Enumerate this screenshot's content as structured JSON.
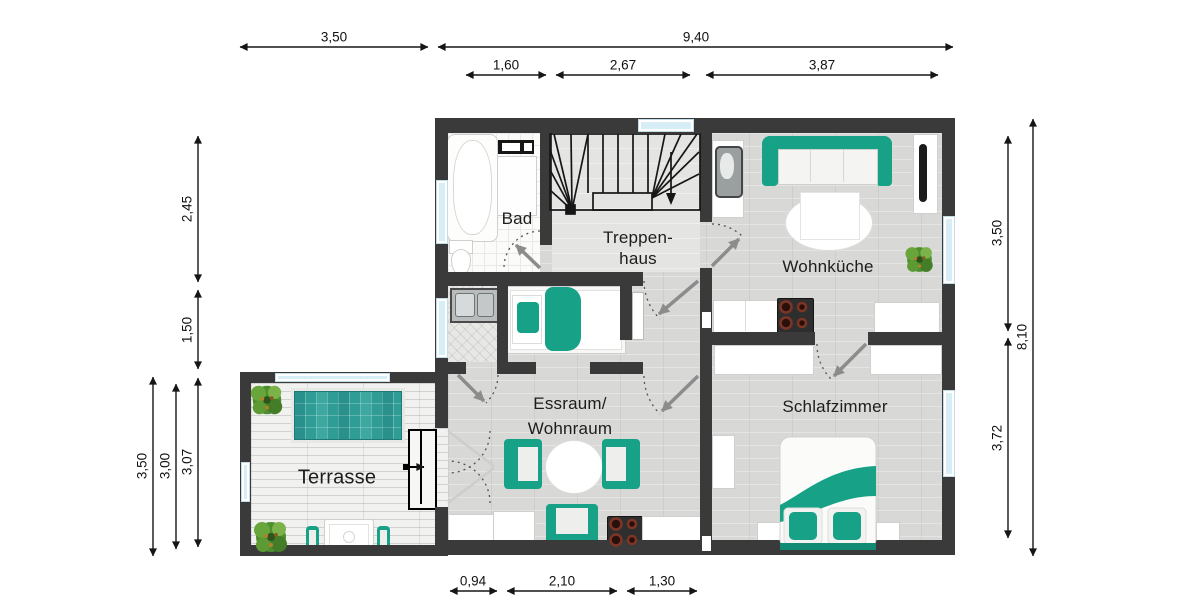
{
  "colors": {
    "wall": "#3a3a3a",
    "teal_furniture": "#17a287",
    "pool_teal": "#2f9d96",
    "floor_gray": "#d8d8d6",
    "window_blue": "#d8eef6",
    "deck": "#f1f1ef"
  },
  "rooms": {
    "bad": "Bad",
    "treppenhaus_line1": "Treppen-",
    "treppenhaus_line2": "haus",
    "wohnkueche": "Wohnküche",
    "essraum_line1": "Essraum/",
    "essraum_line2": "Wohnraum",
    "schlafzimmer": "Schlafzimmer",
    "terrasse": "Terrasse"
  },
  "dimensions": [
    {
      "id": "top-350",
      "value": "3,50",
      "x1": 240,
      "y1": 47,
      "x2": 428,
      "y2": 47,
      "lx": 334,
      "ly": 37,
      "vertical": false
    },
    {
      "id": "top-940",
      "value": "9,40",
      "x1": 438,
      "y1": 47,
      "x2": 953,
      "y2": 47,
      "lx": 696,
      "ly": 37,
      "vertical": false
    },
    {
      "id": "top-160",
      "value": "1,60",
      "x1": 466,
      "y1": 75,
      "x2": 546,
      "y2": 75,
      "lx": 506,
      "ly": 65,
      "vertical": false
    },
    {
      "id": "top-267",
      "value": "2,67",
      "x1": 556,
      "y1": 75,
      "x2": 690,
      "y2": 75,
      "lx": 623,
      "ly": 65,
      "vertical": false
    },
    {
      "id": "top-387",
      "value": "3,87",
      "x1": 706,
      "y1": 75,
      "x2": 938,
      "y2": 75,
      "lx": 822,
      "ly": 65,
      "vertical": false
    },
    {
      "id": "left-245",
      "value": "2,45",
      "x1": 198,
      "y1": 136,
      "x2": 198,
      "y2": 282,
      "lx": 187,
      "ly": 209,
      "vertical": true
    },
    {
      "id": "left-150",
      "value": "1,50",
      "x1": 198,
      "y1": 290,
      "x2": 198,
      "y2": 369,
      "lx": 187,
      "ly": 330,
      "vertical": true
    },
    {
      "id": "left-307",
      "value": "3,07",
      "x1": 198,
      "y1": 378,
      "x2": 198,
      "y2": 547,
      "lx": 187,
      "ly": 462,
      "vertical": true
    },
    {
      "id": "left-300",
      "value": "3,00",
      "x1": 176,
      "y1": 384,
      "x2": 176,
      "y2": 549,
      "lx": 165,
      "ly": 466,
      "vertical": true
    },
    {
      "id": "left-350",
      "value": "3,50",
      "x1": 153,
      "y1": 377,
      "x2": 153,
      "y2": 556,
      "lx": 142,
      "ly": 466,
      "vertical": true
    },
    {
      "id": "right-350",
      "value": "3,50",
      "x1": 1008,
      "y1": 136,
      "x2": 1008,
      "y2": 331,
      "lx": 997,
      "ly": 233,
      "vertical": true
    },
    {
      "id": "right-372",
      "value": "3,72",
      "x1": 1008,
      "y1": 338,
      "x2": 1008,
      "y2": 538,
      "lx": 997,
      "ly": 438,
      "vertical": true
    },
    {
      "id": "right-810",
      "value": "8,10",
      "x1": 1033,
      "y1": 119,
      "x2": 1033,
      "y2": 556,
      "lx": 1022,
      "ly": 337,
      "vertical": true
    },
    {
      "id": "bot-094",
      "value": "0,94",
      "x1": 450,
      "y1": 591,
      "x2": 497,
      "y2": 591,
      "lx": 473,
      "ly": 581,
      "vertical": false
    },
    {
      "id": "bot-210",
      "value": "2,10",
      "x1": 507,
      "y1": 591,
      "x2": 617,
      "y2": 591,
      "lx": 562,
      "ly": 581,
      "vertical": false
    },
    {
      "id": "bot-130",
      "value": "1,30",
      "x1": 627,
      "y1": 591,
      "x2": 697,
      "y2": 591,
      "lx": 662,
      "ly": 581,
      "vertical": false
    }
  ]
}
